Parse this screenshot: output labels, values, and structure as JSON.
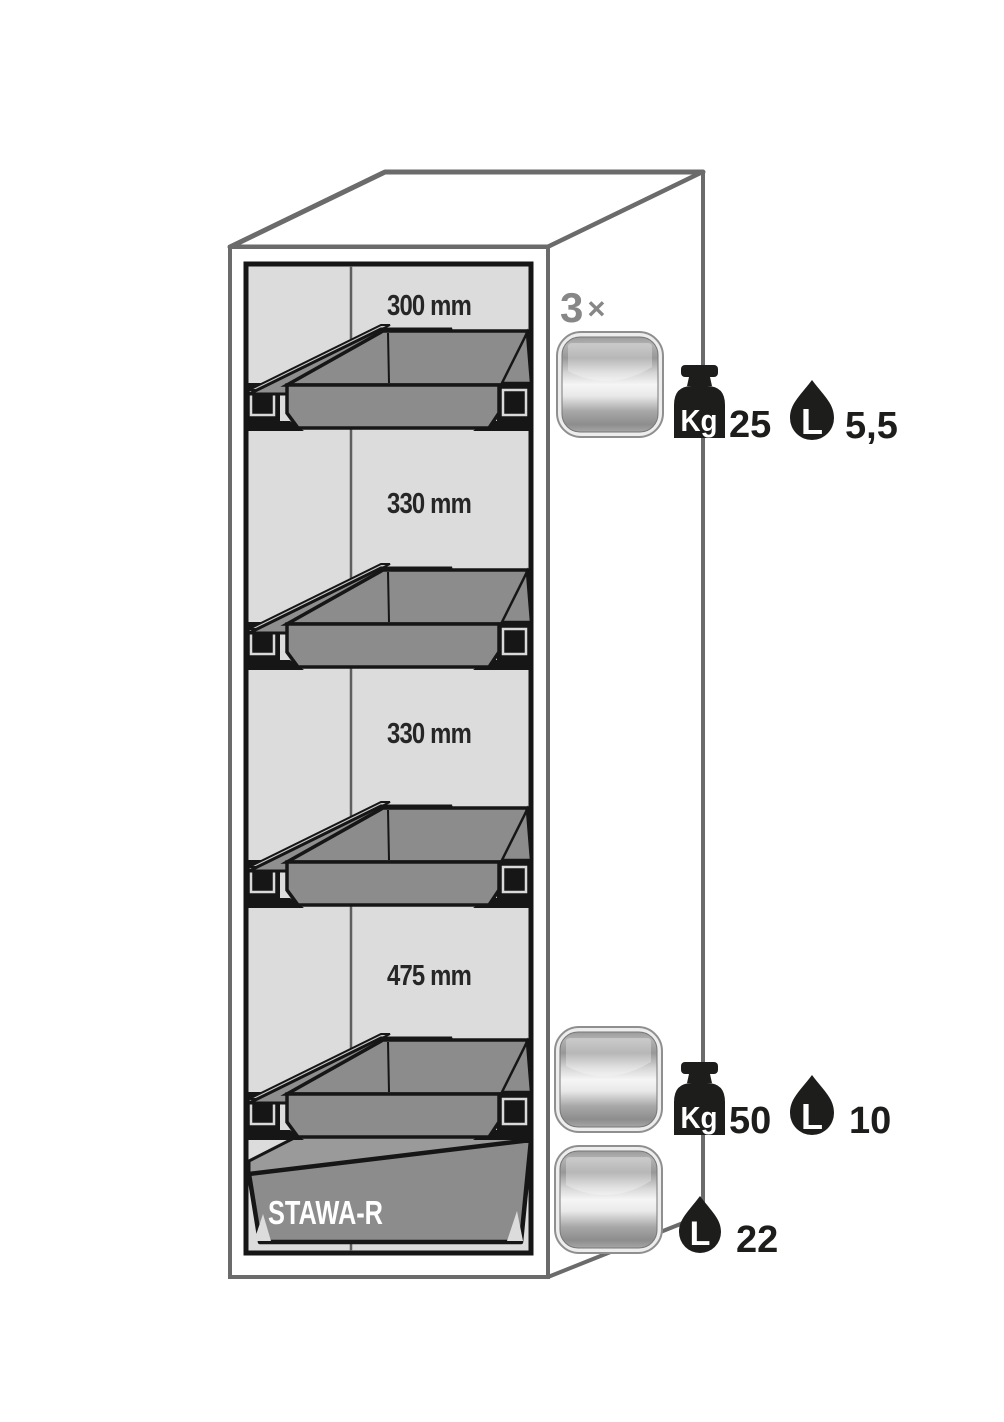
{
  "colors": {
    "background": "#ffffff",
    "cabinet_outline": "#6b6b6b",
    "interior_background": "#dcdcdc",
    "tray_gray": "#8c8c8c",
    "rail_gray": "#8f8f8f",
    "rail_highlight": "#c8c8c8",
    "line_black": "#161616",
    "label_text": "#262626",
    "count_text": "#878787",
    "icon_black": "#1d1d1b",
    "icon_text_white": "#ffffff"
  },
  "cabinet": {
    "compartments": [
      {
        "label": "300 mm"
      },
      {
        "label": "330 mm"
      },
      {
        "label": "330 mm"
      },
      {
        "label": "475 mm"
      }
    ],
    "sump_label": "STAWA-R"
  },
  "annotations": {
    "tray_count": {
      "number": "3",
      "symbol": "×"
    },
    "rows": [
      {
        "weight_unit": "Kg",
        "weight_value": "25",
        "volume_unit": "L",
        "volume_value": "5,5"
      },
      {
        "weight_unit": "Kg",
        "weight_value": "50",
        "volume_unit": "L",
        "volume_value": "10"
      },
      {
        "volume_unit": "L",
        "volume_value": "22"
      }
    ]
  }
}
